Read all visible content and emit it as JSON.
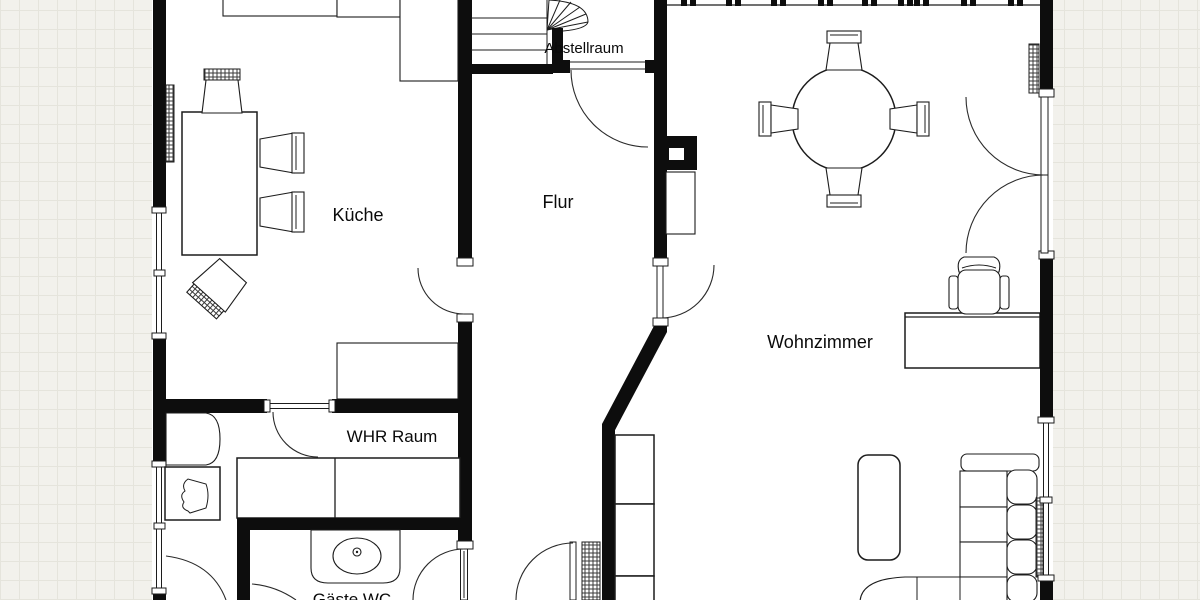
{
  "plan_type": "floor-plan",
  "colors": {
    "wall": "#0d0d0d",
    "line": "#1c1c1c",
    "paper": "#ffffff",
    "outside_background": "#f2f1ec",
    "grid_line": "#e5e4dc"
  },
  "rooms": [
    {
      "id": "kueche",
      "label": "Küche"
    },
    {
      "id": "flur",
      "label": "Flur"
    },
    {
      "id": "abstellraum",
      "label": "Abstellraum"
    },
    {
      "id": "wohnzimmer",
      "label": "Wohnzimmer"
    },
    {
      "id": "whr_raum",
      "label": "WHR Raum"
    },
    {
      "id": "gaeste_wc",
      "label": "Gäste WC"
    }
  ]
}
